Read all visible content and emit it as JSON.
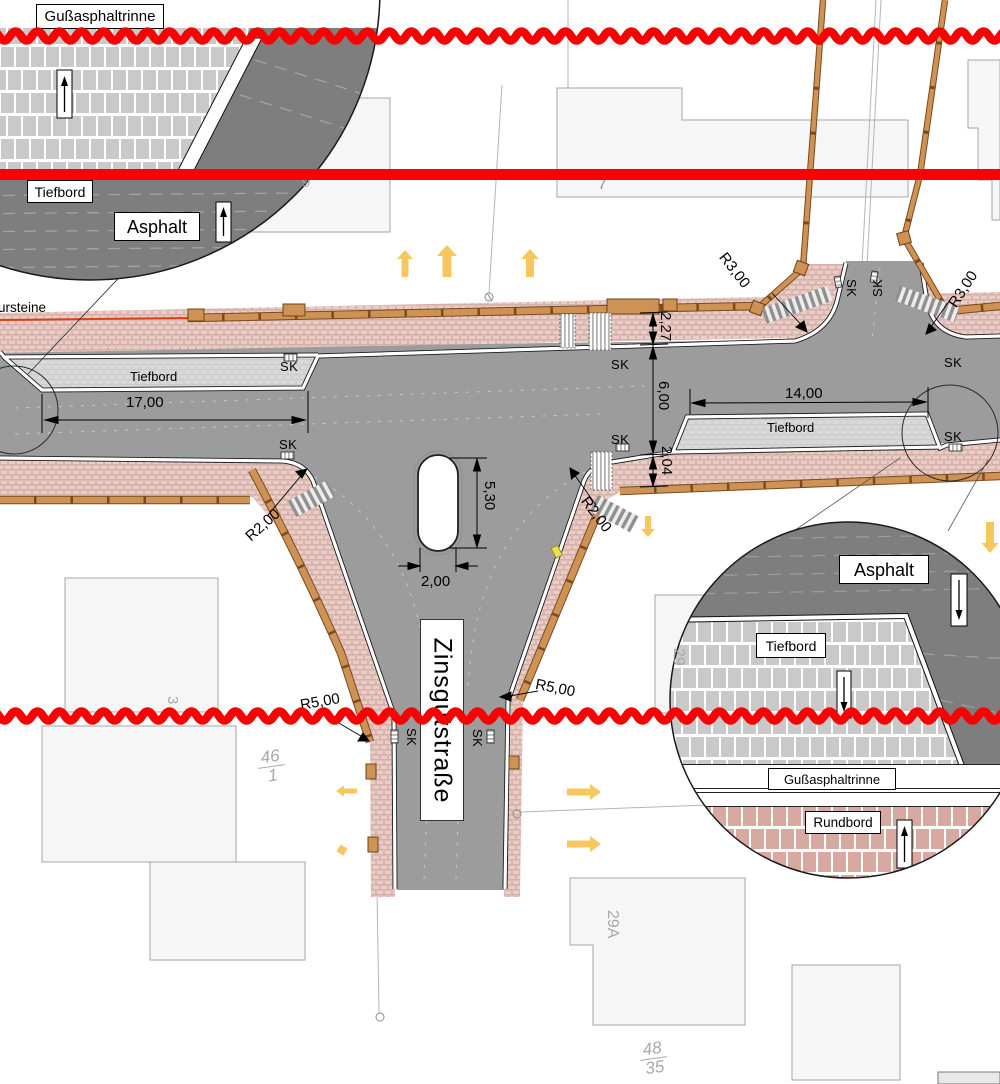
{
  "plan": {
    "street_name": "Zinsgutstraße",
    "materials": {
      "asphalt": "Asphalt",
      "tiefbord": "Tiefbord",
      "gussasphaltrinne": "Gußasphaltrinne",
      "rundbord": "Rundbord",
      "kerb_text_partial": "ursteine",
      "sk": "SK"
    },
    "dimensions": {
      "left_bay": "17,00",
      "right_bay": "14,00",
      "north_footway": "2,27",
      "carriageway": "6,00",
      "south_footway": "2,04",
      "island_length": "5,30",
      "island_width": "2,00",
      "r2": "R2,00",
      "r3": "R3,00",
      "r5": "R5,00"
    },
    "parcels": {
      "p9": "9",
      "p7": "7",
      "p3": "3",
      "p29": "29",
      "p29a": "29A",
      "p46_num": "46",
      "p46_den": "1",
      "p48_num": "48",
      "p48_den": "35"
    },
    "colors": {
      "carriageway": "#9c9c9c",
      "inset_asphalt": "#7e7e7e",
      "footway_brick": "#ebcdc5",
      "parking_bay_brick": "#d9d9d9",
      "kerb_tan": "#cf9255",
      "annotation_red": "#fb0000",
      "direction_arrow_yellow": "#f6c75e"
    }
  }
}
